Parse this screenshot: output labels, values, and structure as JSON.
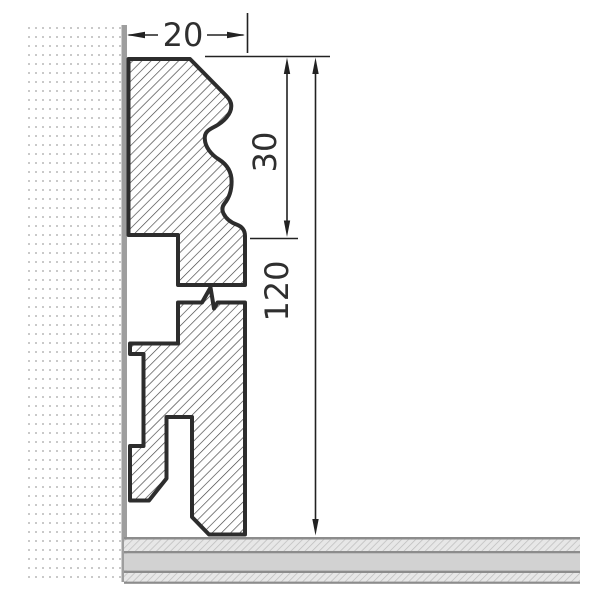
{
  "drawing": {
    "type": "skirting-board-cross-section",
    "dims": {
      "top_width": "20",
      "upper_height": "30",
      "total_height": "120"
    },
    "colors": {
      "outline": "#2d2d2d",
      "hatch_line": "#3f3f3f",
      "wall_dot": "#c9c9c9",
      "wall_strip": "#9e9e9e",
      "dim_line": "#222222",
      "dim_text": "#2f2f2f",
      "floor_border": "#8c8c8c",
      "floor_solid": "#d2d2d2",
      "floor_hatch_bg": "#e7e7e7",
      "floor_hatch_line": "#bcbcbc"
    }
  }
}
